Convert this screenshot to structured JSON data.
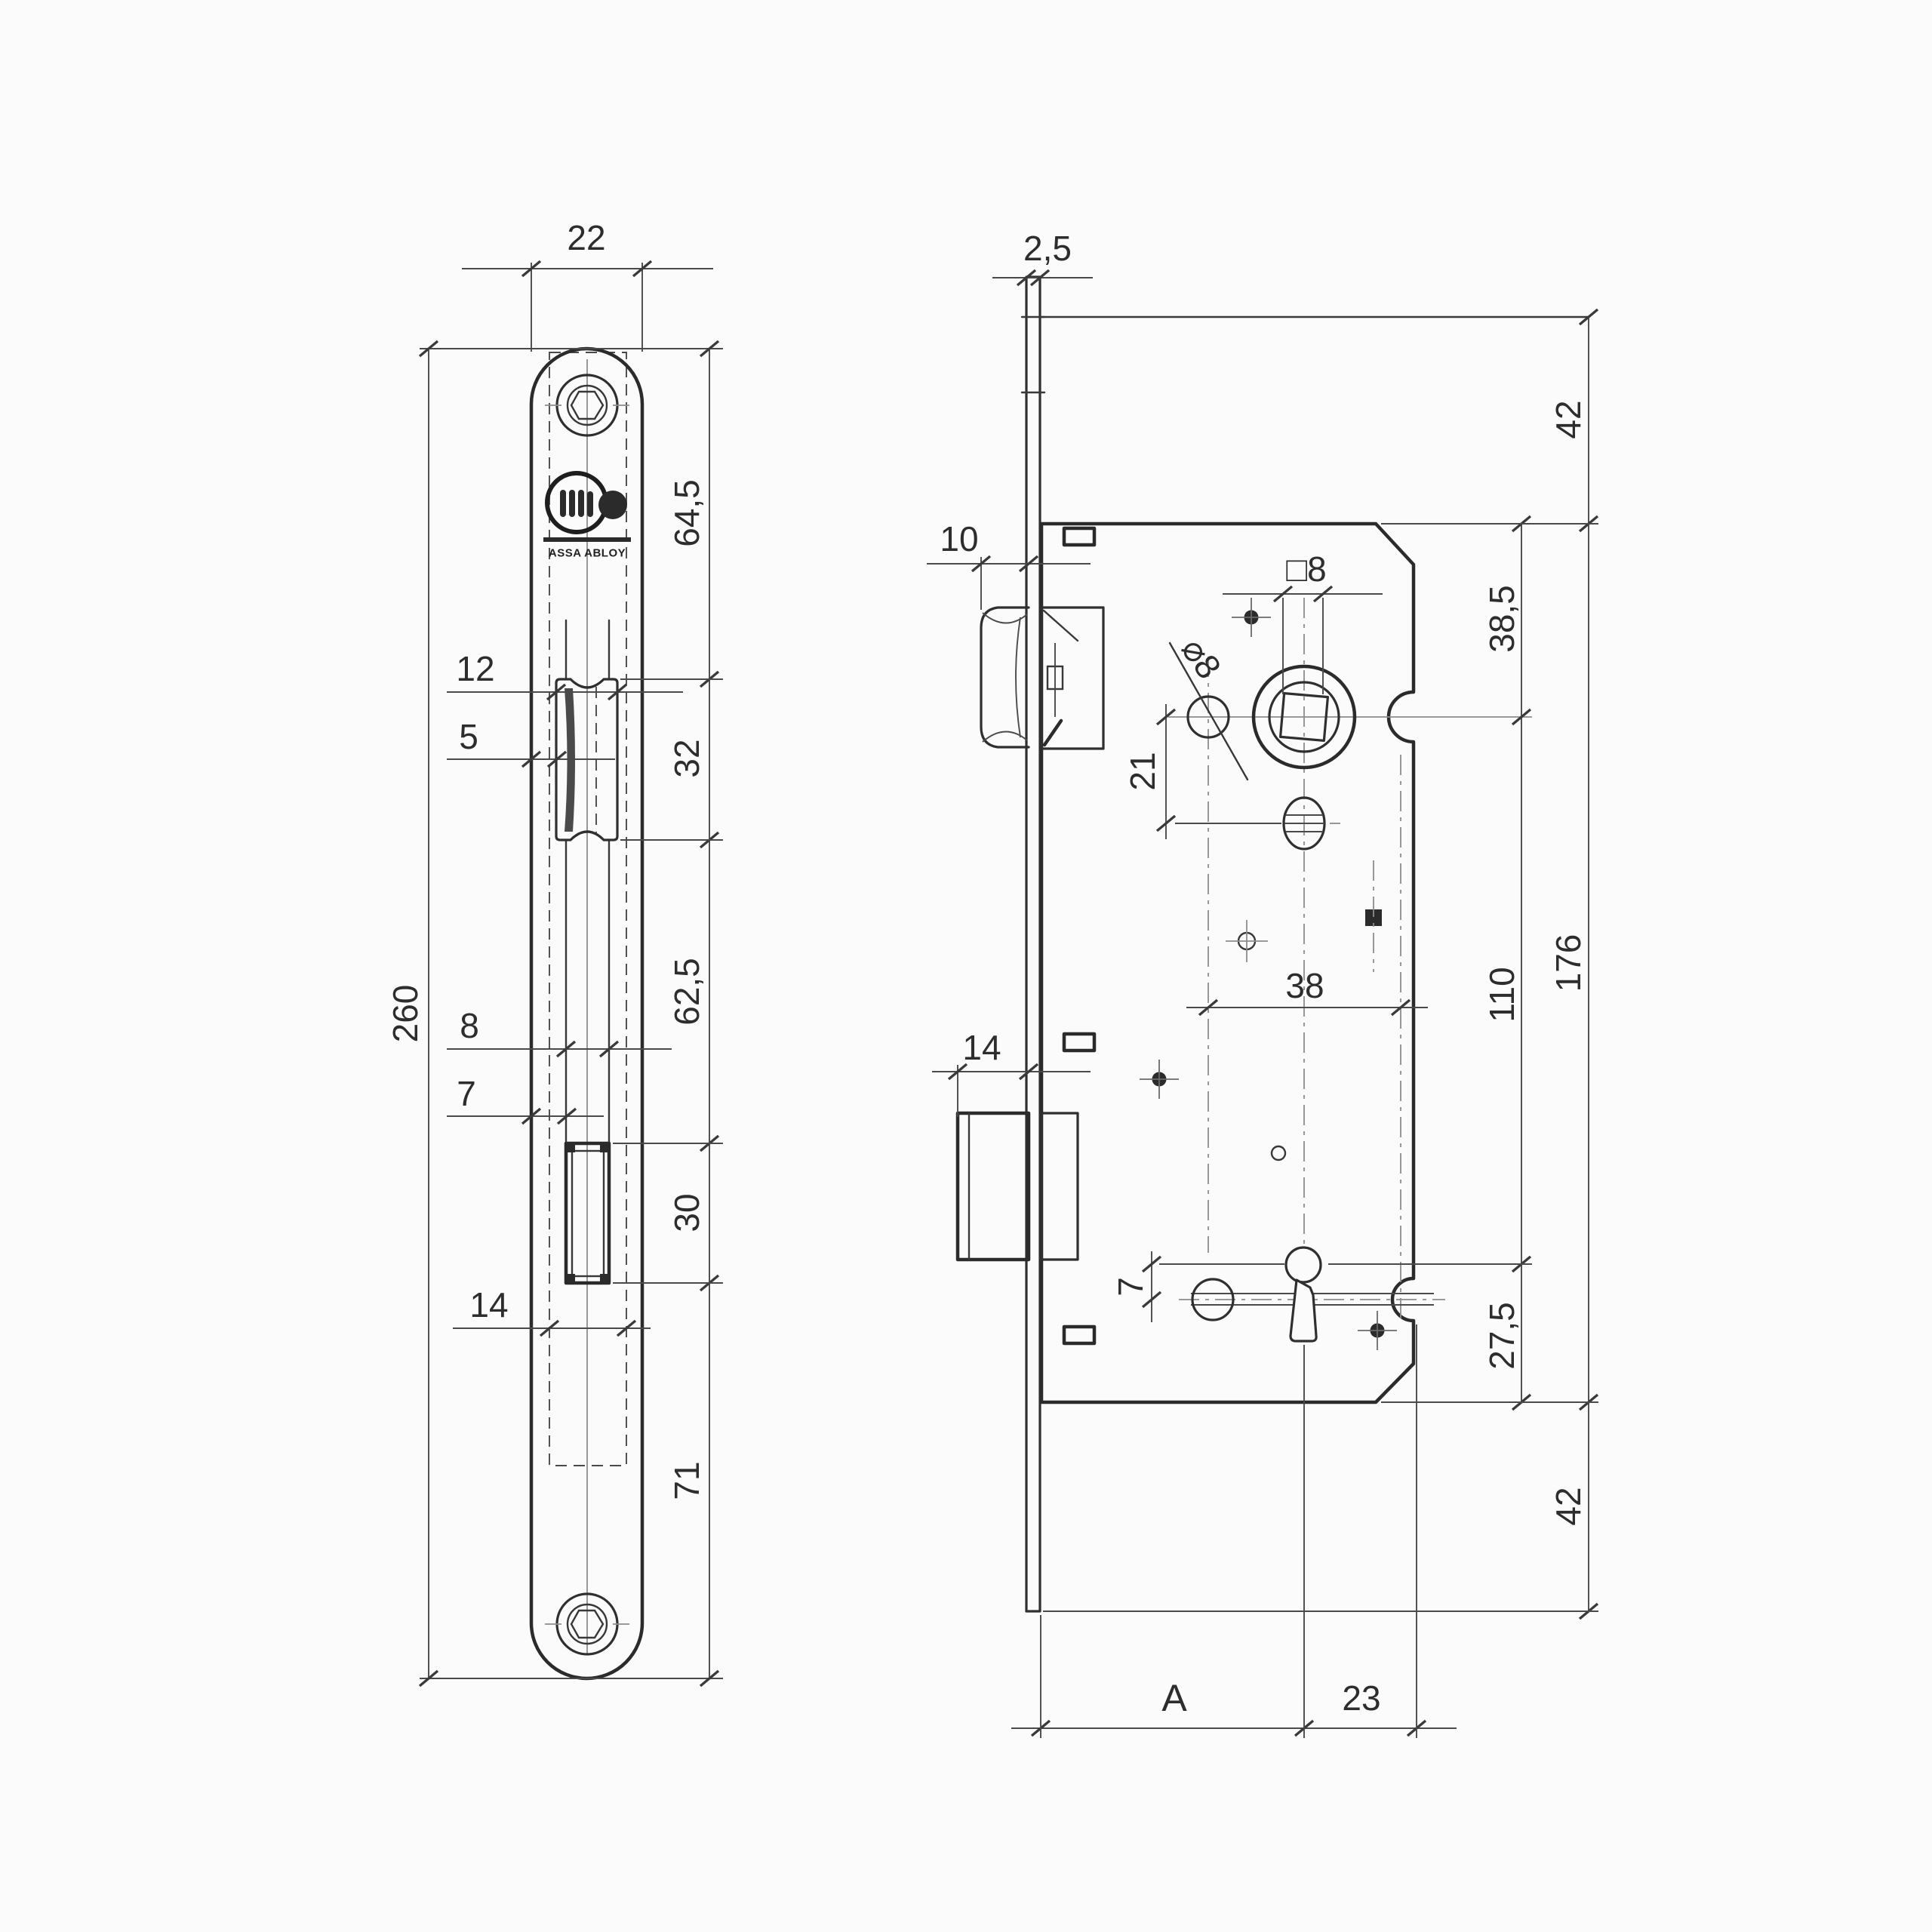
{
  "colors": {
    "background": "#fbfbfb",
    "ink": "#2b2b2b",
    "dim_ink": "#2d2d2d"
  },
  "logo": {
    "sub": "ASSA ABLOY"
  },
  "front": {
    "dims": {
      "plate_width": "22",
      "plate_height": "260",
      "top_to_latch": "64,5",
      "latch_height": "32",
      "latch_to_slot": "62,5",
      "slot_height": "30",
      "slot_to_bottom": "71",
      "latch_width": "12",
      "latch_bevel": "5",
      "slot_width": "8",
      "slot_offset": "7",
      "case_width": "14"
    }
  },
  "side": {
    "dims": {
      "plate_thickness": "2,5",
      "latch_protrusion": "10",
      "bolt_protrusion": "14",
      "spindle_square": "□8",
      "hole_diameter": "⌀8",
      "hub_to_oval": "21",
      "hole_spacing": "38",
      "key_offset": "7",
      "top_margin": "42",
      "top_to_hub": "38,5",
      "case_height": "176",
      "hub_to_key": "110",
      "key_to_bottom": "27,5",
      "bottom_margin": "42",
      "backset": "A",
      "key_to_edge": "23"
    }
  }
}
